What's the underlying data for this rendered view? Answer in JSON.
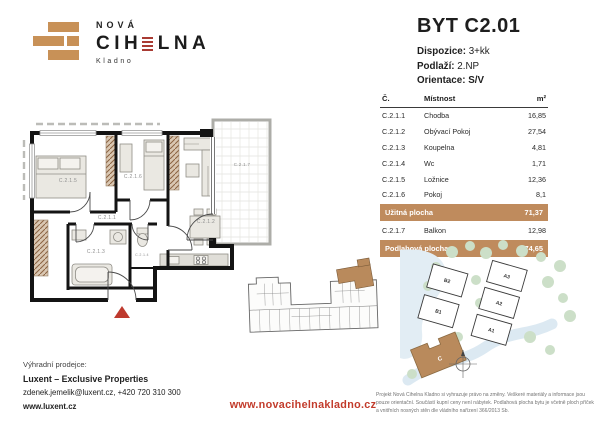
{
  "brand": {
    "top": "NOVÁ",
    "main_pre": "CIH",
    "main_post": "LNA",
    "sub": "Kladno"
  },
  "header": {
    "title": "BYT C2.01",
    "dispozice_label": "Dispozice:",
    "dispozice": "3+kk",
    "podlazi_label": "Podlaží:",
    "podlazi": "2.NP",
    "orientace_label": "Orientace:",
    "orientace": "S/V"
  },
  "table": {
    "headers": {
      "no": "Č.",
      "room": "Místnost",
      "area": "m²"
    },
    "rows": [
      {
        "no": "C.2.1.1",
        "room": "Chodba",
        "area": "16,85"
      },
      {
        "no": "C.2.1.2",
        "room": "Obývací Pokoj",
        "area": "27,54"
      },
      {
        "no": "C.2.1.3",
        "room": "Koupelna",
        "area": "4,81"
      },
      {
        "no": "C.2.1.4",
        "room": "Wc",
        "area": "1,71"
      },
      {
        "no": "C.2.1.5",
        "room": "Ložnice",
        "area": "12,36"
      },
      {
        "no": "C.2.1.6",
        "room": "Pokoj",
        "area": "8,1"
      }
    ],
    "usable_label": "Užitná plocha",
    "usable_value": "71,37",
    "balcony": {
      "no": "C.2.1.7",
      "room": "Balkon",
      "area": "12,98"
    },
    "total_label": "Podlahová plocha",
    "total_value": "74,65"
  },
  "floorplan": {
    "labels": {
      "chodba": "C.2.1.1",
      "obyvaci": "C.2.1.2",
      "koupelna": "C.2.1.3",
      "wc": "C.2.1.4",
      "loznice": "C.2.1.5",
      "pokoj": "C.2.1.6",
      "balkon": "C.2.1.7"
    }
  },
  "siteplan": {
    "buildings": {
      "b2": "B2",
      "b1": "B1",
      "a3": "A3",
      "a2": "A2",
      "a1": "A1",
      "c": "C"
    }
  },
  "footer": {
    "seller_label": "Výhradní prodejce:",
    "seller_name": "Luxent – Exclusive Properties",
    "seller_contact": "zdenek.jemelik@luxent.cz, +420 720 310 300",
    "seller_web": "www.luxent.cz",
    "project_web": "www.novacihelnakladno.cz",
    "disclaimer": "Projekt Nová Cihelna Kladno si vyhrazuje právo na změny. Veškeré materiály a informace jsou pouze orientační. Součástí kupní ceny není nábytek. Podlahová plocha bytu je včetně ploch příček a vnitřních nosných stěn dle vládního nařízení 366/2013 Sb."
  },
  "colors": {
    "accent_tan": "#c89157",
    "table_highlight": "#bf8b5d",
    "accent_red": "#c23b2b"
  }
}
